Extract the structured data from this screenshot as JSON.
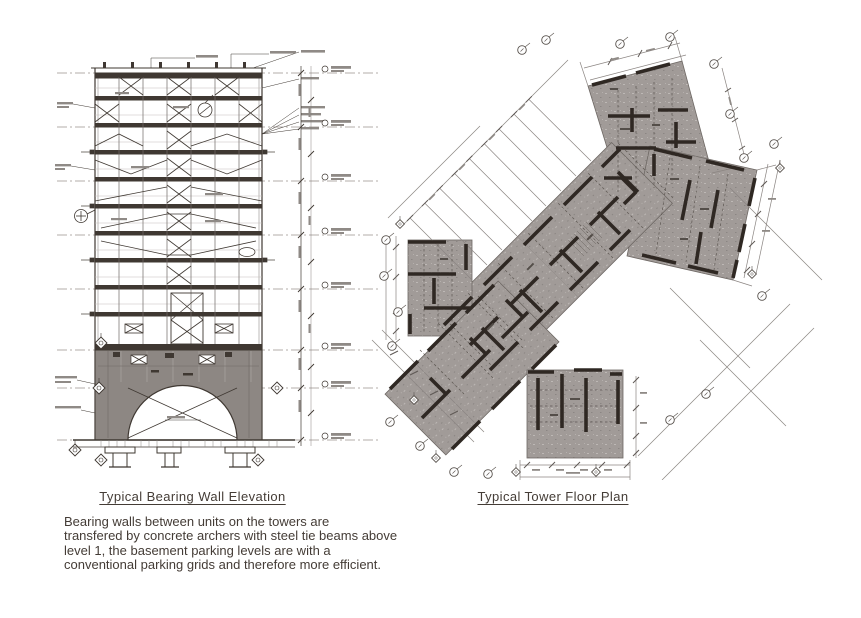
{
  "figures": {
    "elevation": {
      "title": "Typical Bearing Wall Elevation"
    },
    "floor_plan": {
      "title": "Typical Tower Floor Plan"
    }
  },
  "caption": {
    "text": "Bearing walls between units on the towers are\ntransfered by concrete archers with steel tie beams above\nlevel 1, the basement parking levels are with a\nconventional parking grids and therefore more efficient."
  },
  "colors": {
    "background": "#ffffff",
    "ink": "#3f3832",
    "wall_dark": "#2f2823",
    "plan_slab_gray": "#a19b98",
    "arch_wall_gray": "#8d8783",
    "line_light": "#8b8582"
  }
}
